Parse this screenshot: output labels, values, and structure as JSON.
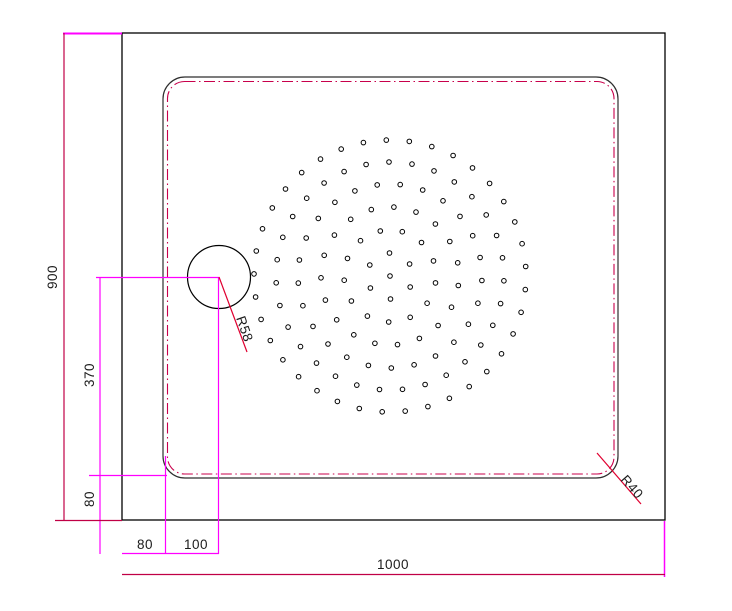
{
  "drawing": {
    "type": "technical-drawing",
    "subject": "shower tray plan view"
  },
  "labels": {
    "overall_height": "900",
    "drain_center_height": "370",
    "bottom_edge_offset": "80",
    "drain_offset_a": "80",
    "drain_offset_b": "100",
    "overall_width": "1000",
    "drain_radius": "R58",
    "corner_radius": "R40"
  },
  "colors": {
    "outline": "#000000",
    "inner_edge": "#2e2e2e",
    "trim_line": "#c8004b",
    "dimension": "#c00045",
    "extension": "#ff00ff",
    "leader": "#e00030",
    "text": "#1c1c1c"
  },
  "geometry": {
    "drain": {
      "cx": 219,
      "cy": 277,
      "r": 31.5
    },
    "hole_pattern": {
      "cx": 390,
      "cy": 276,
      "dot_r": 2.3,
      "center_dot": true,
      "rings": [
        {
          "r": 23,
          "n": 6,
          "off": 0.5
        },
        {
          "r": 46,
          "n": 13,
          "off": 0.15
        },
        {
          "r": 69,
          "n": 19,
          "off": 0.8
        },
        {
          "r": 92,
          "n": 25,
          "off": 0.3
        },
        {
          "r": 114,
          "n": 31,
          "off": 0.65
        },
        {
          "r": 136,
          "n": 37,
          "off": 0.1
        }
      ]
    }
  }
}
